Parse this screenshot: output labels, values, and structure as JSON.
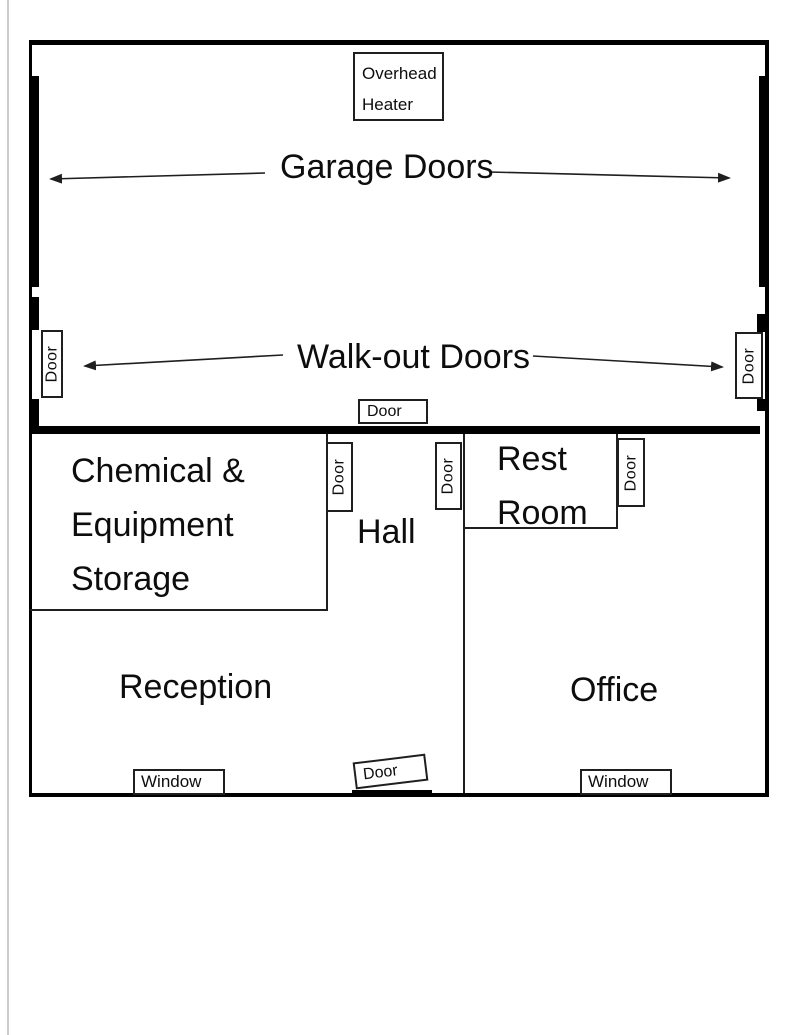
{
  "colors": {
    "ink": "#000000",
    "line": "#1f1f1f",
    "background": "#ffffff",
    "scan_artifact": "#cccccc"
  },
  "labels": {
    "overhead_heater_line1": "Overhead",
    "overhead_heater_line2": "Heater",
    "garage_doors": "Garage Doors",
    "walkout_doors": "Walk-out Doors",
    "door": "Door",
    "window": "Window"
  },
  "rooms": {
    "storage_line1": "Chemical &",
    "storage_line2": "Equipment",
    "storage_line3": "Storage",
    "hall": "Hall",
    "restroom_line1": "Rest",
    "restroom_line2": "Room",
    "reception": "Reception",
    "office": "Office"
  }
}
